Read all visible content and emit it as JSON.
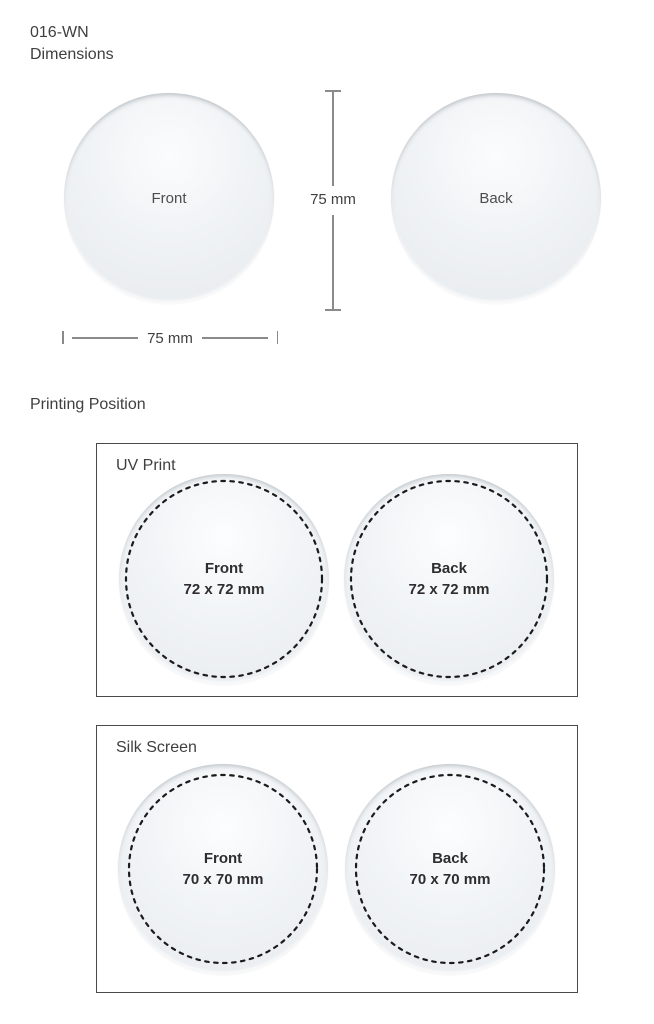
{
  "header": {
    "product_code": "016-WN",
    "dimensions_heading": "Dimensions"
  },
  "dimensions_section": {
    "front_label": "Front",
    "back_label": "Back",
    "width_dimension": "75 mm",
    "height_dimension": "75 mm"
  },
  "printing_section": {
    "title": "Printing Position",
    "methods": [
      {
        "name": "UV Print",
        "areas": [
          {
            "label": "Front",
            "size": "72 x 72 mm"
          },
          {
            "label": "Back",
            "size": "72 x 72 mm"
          }
        ]
      },
      {
        "name": "Silk Screen",
        "areas": [
          {
            "label": "Front",
            "size": "70 x 70 mm"
          },
          {
            "label": "Back",
            "size": "70 x 70 mm"
          }
        ]
      }
    ]
  },
  "colors": {
    "background": "#ffffff",
    "text_primary": "#3f3f3f",
    "coaster_fill": "#e8ebee",
    "dimension_line": "#8a8a8a",
    "box_border": "#4a4a4a",
    "dashed_stroke": "#1b1b1b"
  }
}
